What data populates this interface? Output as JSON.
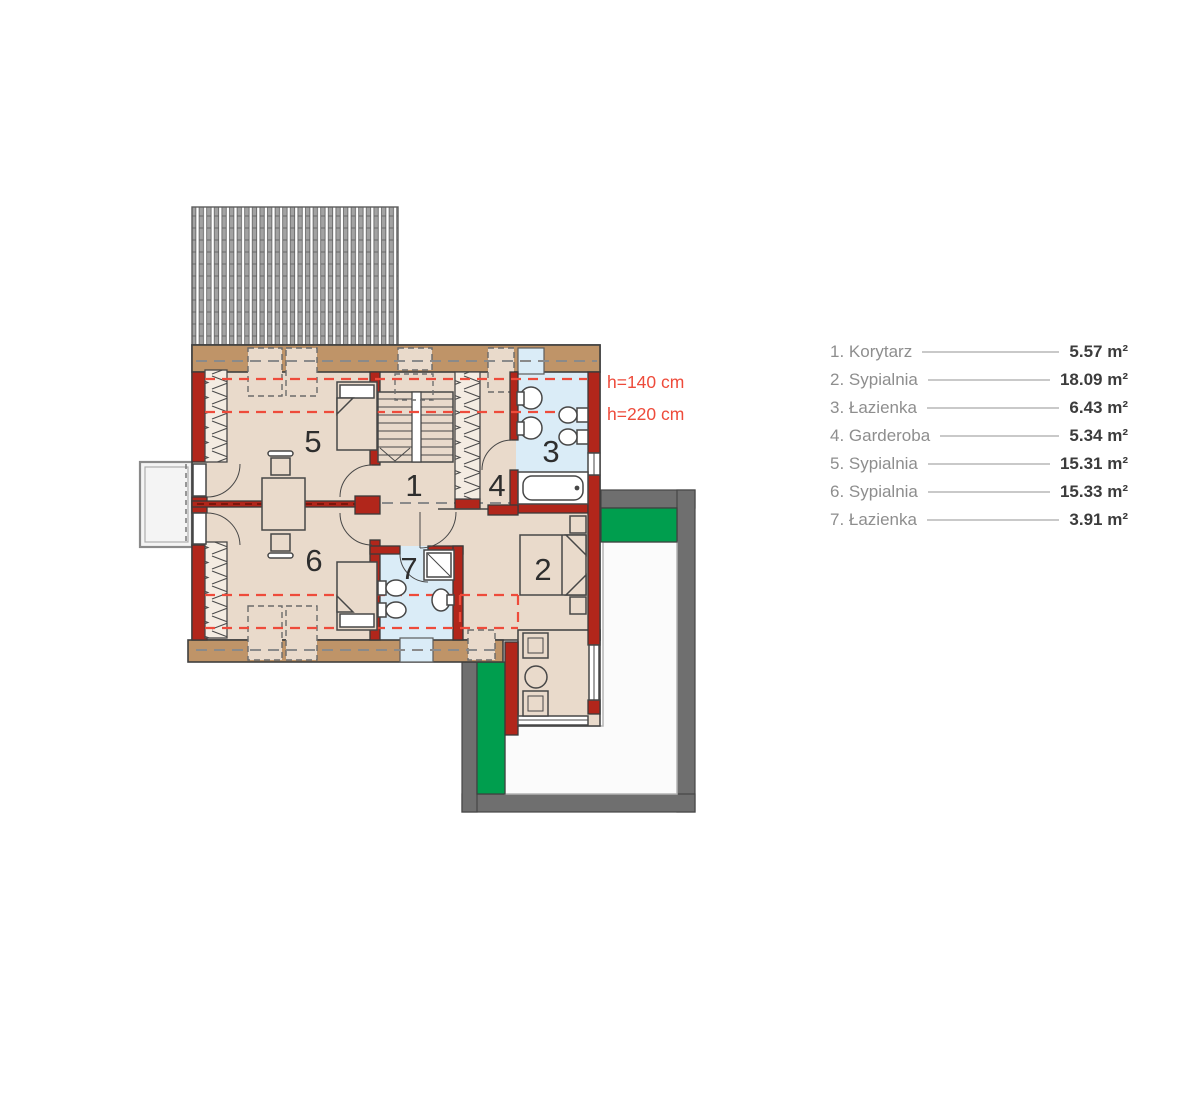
{
  "colors": {
    "red": "#b1261b",
    "tan": "#bf9468",
    "floor": "#e9dacb",
    "bath": "#daecf7",
    "green": "#009e4e",
    "terrace": "#6f6f6f",
    "dashred": "#ee4b3b",
    "line": "#474747"
  },
  "plan": {
    "rooms": [
      {
        "label": "1"
      },
      {
        "label": "2"
      },
      {
        "label": "3"
      },
      {
        "label": "4"
      },
      {
        "label": "5"
      },
      {
        "label": "6"
      },
      {
        "label": "7"
      }
    ],
    "annotations": {
      "h140": "h=140 cm",
      "h220": "h=220 cm"
    }
  },
  "legend": {
    "items": [
      {
        "label": "1. Korytarz",
        "area": "5.57 m²"
      },
      {
        "label": "2. Sypialnia",
        "area": "18.09 m²"
      },
      {
        "label": "3. Łazienka",
        "area": "6.43 m²"
      },
      {
        "label": "4. Garderoba",
        "area": "5.34 m²"
      },
      {
        "label": "5. Sypialnia",
        "area": "15.31 m²"
      },
      {
        "label": "6. Sypialnia",
        "area": "15.33 m²"
      },
      {
        "label": "7. Łazienka",
        "area": "3.91 m²"
      }
    ]
  }
}
